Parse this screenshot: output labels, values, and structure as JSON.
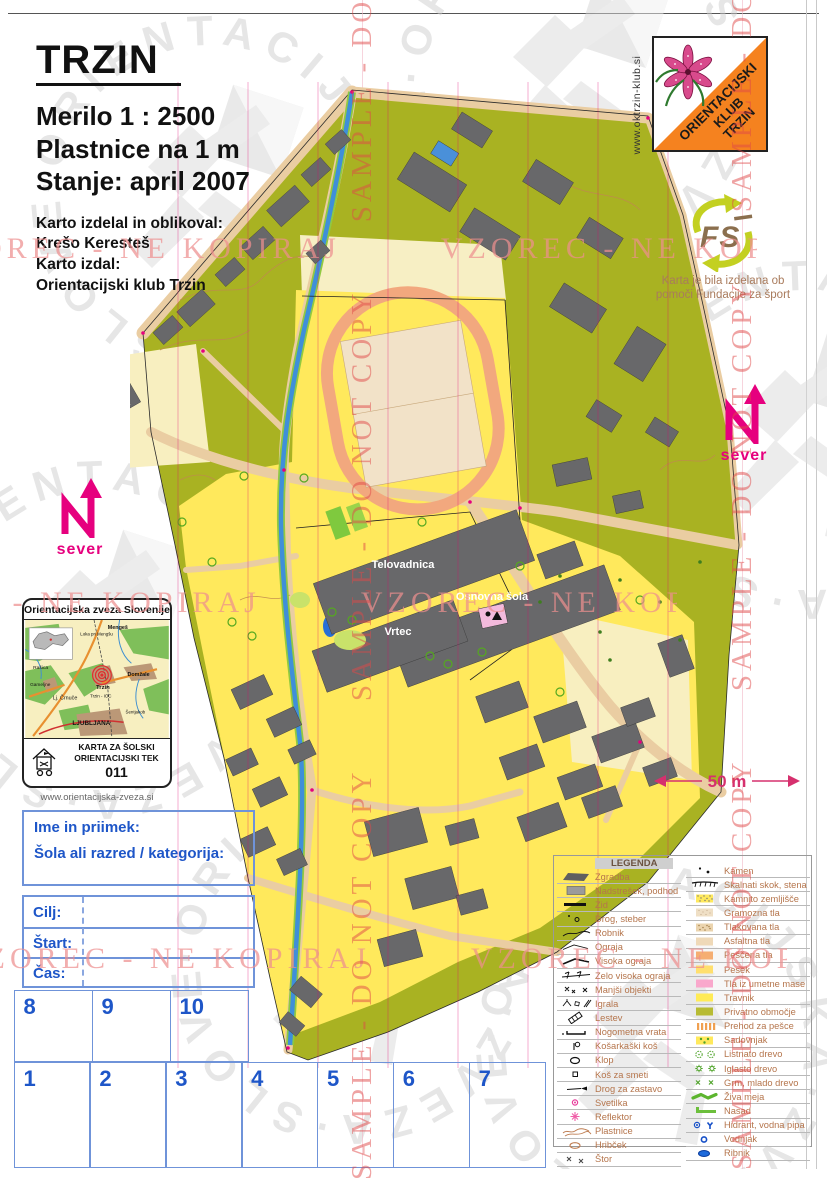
{
  "title_block": {
    "title": "TRZIN",
    "scale": "Merilo 1 : 2500",
    "contours": "Plastnice na 1 m",
    "status": "Stanje: april 2007",
    "credits": [
      "Karto izdelal in oblikoval:",
      "Krešo Keresteš",
      "Karto izdal:",
      "Orientacijski klub Trzin"
    ]
  },
  "club": {
    "website": "www.oktrzin-klub.si",
    "logo_lines": [
      "ORIENTACIJSKI",
      "KLUB",
      "TRZIN"
    ]
  },
  "foundation": {
    "logo_text": "FS",
    "caption_line1": "Karta je bila izdelana ob",
    "caption_line2": "pomoči Fundacije za šport"
  },
  "north": {
    "label": "sever"
  },
  "map": {
    "labels": [
      "Cerkev",
      "Telovadnica",
      "Osnovna šola",
      "Vrtec"
    ],
    "scale_label": "50 m"
  },
  "ozs": {
    "header": "Orientacijska zveza Slovenije",
    "places": [
      "Mengeš",
      "Loka pri Mengšu",
      "Rašica",
      "Trzin",
      "Domžale",
      "Gameljne",
      "Lj. Črnuče",
      "Trzin - IOC",
      "Šentjakob",
      "LJUBLJANA"
    ],
    "footer_line1": "KARTA ZA ŠOLSKI",
    "footer_line2": "ORIENTACIJSKI TEK",
    "number": "011",
    "website": "www.orientacijska-zveza.si"
  },
  "form": {
    "name_label": "Ime in priimek:",
    "school_label": "Šola ali razred / kategorija:",
    "rows": [
      "Cilj:",
      "Štart:",
      "Čas:"
    ],
    "top_numbers": [
      "8",
      "9",
      "10"
    ],
    "bottom_numbers": [
      "1",
      "2",
      "3",
      "4",
      "5",
      "6",
      "7"
    ]
  },
  "legend": {
    "title": "LEGENDA",
    "left": [
      {
        "sym": "building",
        "label": "Zgradba"
      },
      {
        "sym": "canopy",
        "label": "Nadstrešek, podhod"
      },
      {
        "sym": "wall",
        "label": "Zid"
      },
      {
        "sym": "pole",
        "label": "Drog, steber"
      },
      {
        "sym": "curb",
        "label": "Robnik"
      },
      {
        "sym": "fence",
        "label": "Ograja"
      },
      {
        "sym": "fence-high",
        "label": "Visoka ograja"
      },
      {
        "sym": "fence-very-high",
        "label": "Zelo visoka ograja"
      },
      {
        "sym": "small-objects",
        "label": "Manjši objekti"
      },
      {
        "sym": "playground",
        "label": "Igrala"
      },
      {
        "sym": "ladder",
        "label": "Lestev"
      },
      {
        "sym": "goal",
        "label": "Nogometna vrata"
      },
      {
        "sym": "basket",
        "label": "Košarkaški koš"
      },
      {
        "sym": "bench",
        "label": "Klop"
      },
      {
        "sym": "bin",
        "label": "Koš za smeti"
      },
      {
        "sym": "flagpole",
        "label": "Drog za zastavo"
      },
      {
        "sym": "lamp",
        "label": "Svetilka"
      },
      {
        "sym": "floodlight",
        "label": "Reflektor"
      },
      {
        "sym": "contours",
        "label": "Plastnice"
      },
      {
        "sym": "knoll",
        "label": "Hribček"
      },
      {
        "sym": "stump",
        "label": "Štor"
      }
    ],
    "right": [
      {
        "sym": "stone",
        "label": "Kamen"
      },
      {
        "sym": "cliff",
        "label": "Skalnati skok, stena"
      },
      {
        "sym": "stony-ground",
        "label": "Kamnito zemljišče"
      },
      {
        "sym": "gravel",
        "label": "Gramozna tla"
      },
      {
        "sym": "paving",
        "label": "Tlakovana tla"
      },
      {
        "sym": "asphalt",
        "label": "Asfaltna tla"
      },
      {
        "sym": "sandy-ground",
        "label": "Peščena tla"
      },
      {
        "sym": "sand",
        "label": "Pesek"
      },
      {
        "sym": "synthetic",
        "label": "Tla iz umetne mase"
      },
      {
        "sym": "grass",
        "label": "Travnik"
      },
      {
        "sym": "private",
        "label": "Privatno območje"
      },
      {
        "sym": "crossing",
        "label": "Prehod za pešce"
      },
      {
        "sym": "orchard",
        "label": "Sadovnjak"
      },
      {
        "sym": "deciduous",
        "label": "Listnato drevo"
      },
      {
        "sym": "conifer",
        "label": "Iglasto drevo"
      },
      {
        "sym": "bush",
        "label": "Grm, mlado drevo"
      },
      {
        "sym": "hedge",
        "label": "Živa meja"
      },
      {
        "sym": "plantation",
        "label": "Nasad"
      },
      {
        "sym": "hydrant",
        "label": "Hidrant, vodna pipa"
      },
      {
        "sym": "well",
        "label": "Vodnjak"
      },
      {
        "sym": "pond",
        "label": "Ribnik"
      }
    ]
  },
  "watermarks": {
    "horizontal": "VZOREC - NE KOPIRAJ",
    "vertical": "SAMPLE - DO NOT COPY",
    "ring": "·ORIENTACIJSKA·ZVEZA·SLOVENIJE"
  },
  "colors": {
    "map_olive": "#A9B222",
    "map_yellow": "#FFE95C",
    "road_tan": "#EACDA2",
    "building_gray": "#68686A",
    "water_blue": "#3F8FD9",
    "track_orange": "#F2A87E",
    "form_blue": "#1E56C8",
    "legend_text": "#B5754C",
    "magenta": "#E6007E",
    "club_orange": "#F5821F",
    "watermark_pink": "#EE8F8F",
    "watermark_red": "#E04848"
  }
}
